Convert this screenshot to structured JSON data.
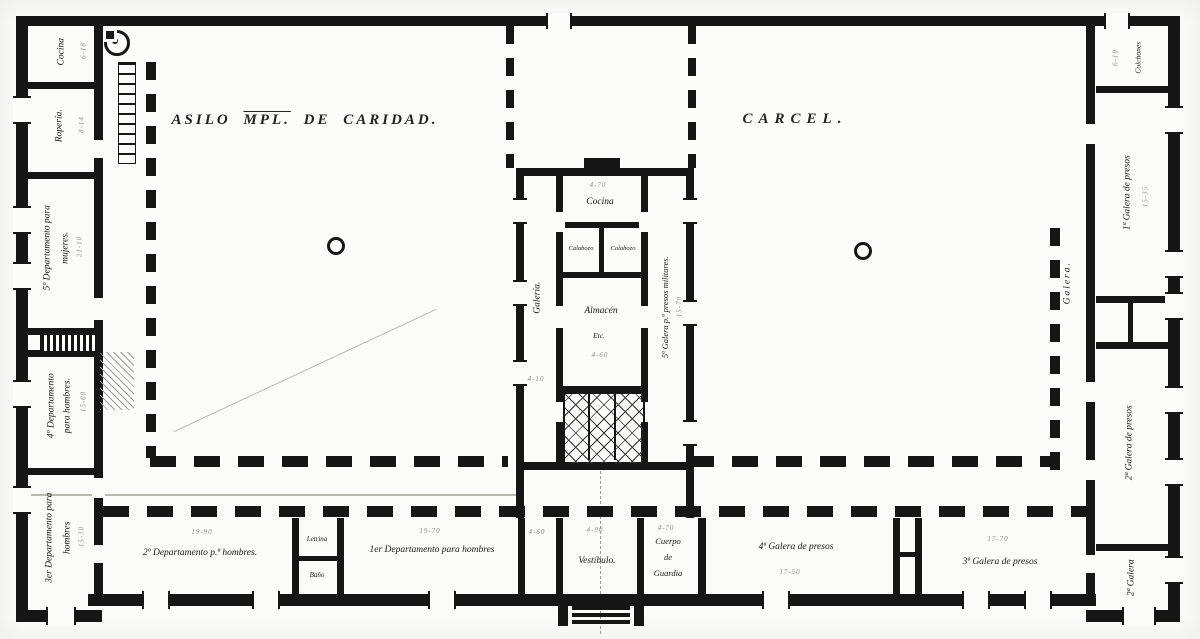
{
  "titles": {
    "asilo_pre": "ASILO ",
    "asilo_mpl": "MPL.",
    "asilo_post": " DE CARIDAD.",
    "carcel": "CARCEL."
  },
  "left_wing": {
    "cocina": {
      "label": "Cocina",
      "dim": "6-18"
    },
    "roperia": {
      "label": "Ropería.",
      "dim": "8-14"
    },
    "mujeres": {
      "line1": "5º Departamento para",
      "line2": "mujeres.",
      "dim": "21-10"
    },
    "hombres4": {
      "line1": "4º Departamento",
      "line2": "para hombres.",
      "dim": "15-60"
    },
    "hombres3": {
      "line1": "3er Departamento para",
      "line2": "hombres",
      "dim": "15-30"
    }
  },
  "bottom_wing": {
    "dept2": {
      "label": "2º Departamento p.ª hombres.",
      "dim": "19-90"
    },
    "letrina": {
      "label": "Letrina"
    },
    "bano": {
      "label": "Baño"
    },
    "dept1": {
      "label": "1er Departamento para hombres",
      "dim": "19-70"
    },
    "pasillo": {
      "dim": "4-60"
    },
    "vestibulo": {
      "label": "Vestíbulo.",
      "dim": "4-90"
    },
    "cuerpo": {
      "line1": "Cuerpo",
      "line2": "de",
      "line3": "Guardia",
      "dim": "4-70"
    },
    "galera4": {
      "label": "4ª Galera de presos",
      "dim": "17-50"
    },
    "galera3": {
      "label": "3ª Galera de presos",
      "dim": "17-70"
    }
  },
  "right_wing": {
    "colchones": {
      "label": "Colchones",
      "dim": "6-10"
    },
    "galera1": {
      "label": "1ª Galera de presos",
      "dim": "15-35"
    },
    "galera2": {
      "label": "2ª Galera de presos"
    },
    "galera2b": {
      "label": "2ª Galera"
    },
    "corridor": {
      "label": "Galera."
    }
  },
  "center_block": {
    "cocina": {
      "label": "Cocina",
      "dim": "4-70"
    },
    "calabozo_izq": {
      "label": "Calabozo"
    },
    "calabozo_der": {
      "label": "Calabozo"
    },
    "almacen": {
      "label": "Almacén",
      "etc": "Etc.",
      "dim": "4-60"
    },
    "galeria": {
      "label": "Galería.",
      "dim": "4-10"
    },
    "militares": {
      "label": "5ª Galera p.ª presos militares.",
      "dim": "15-70"
    }
  }
}
